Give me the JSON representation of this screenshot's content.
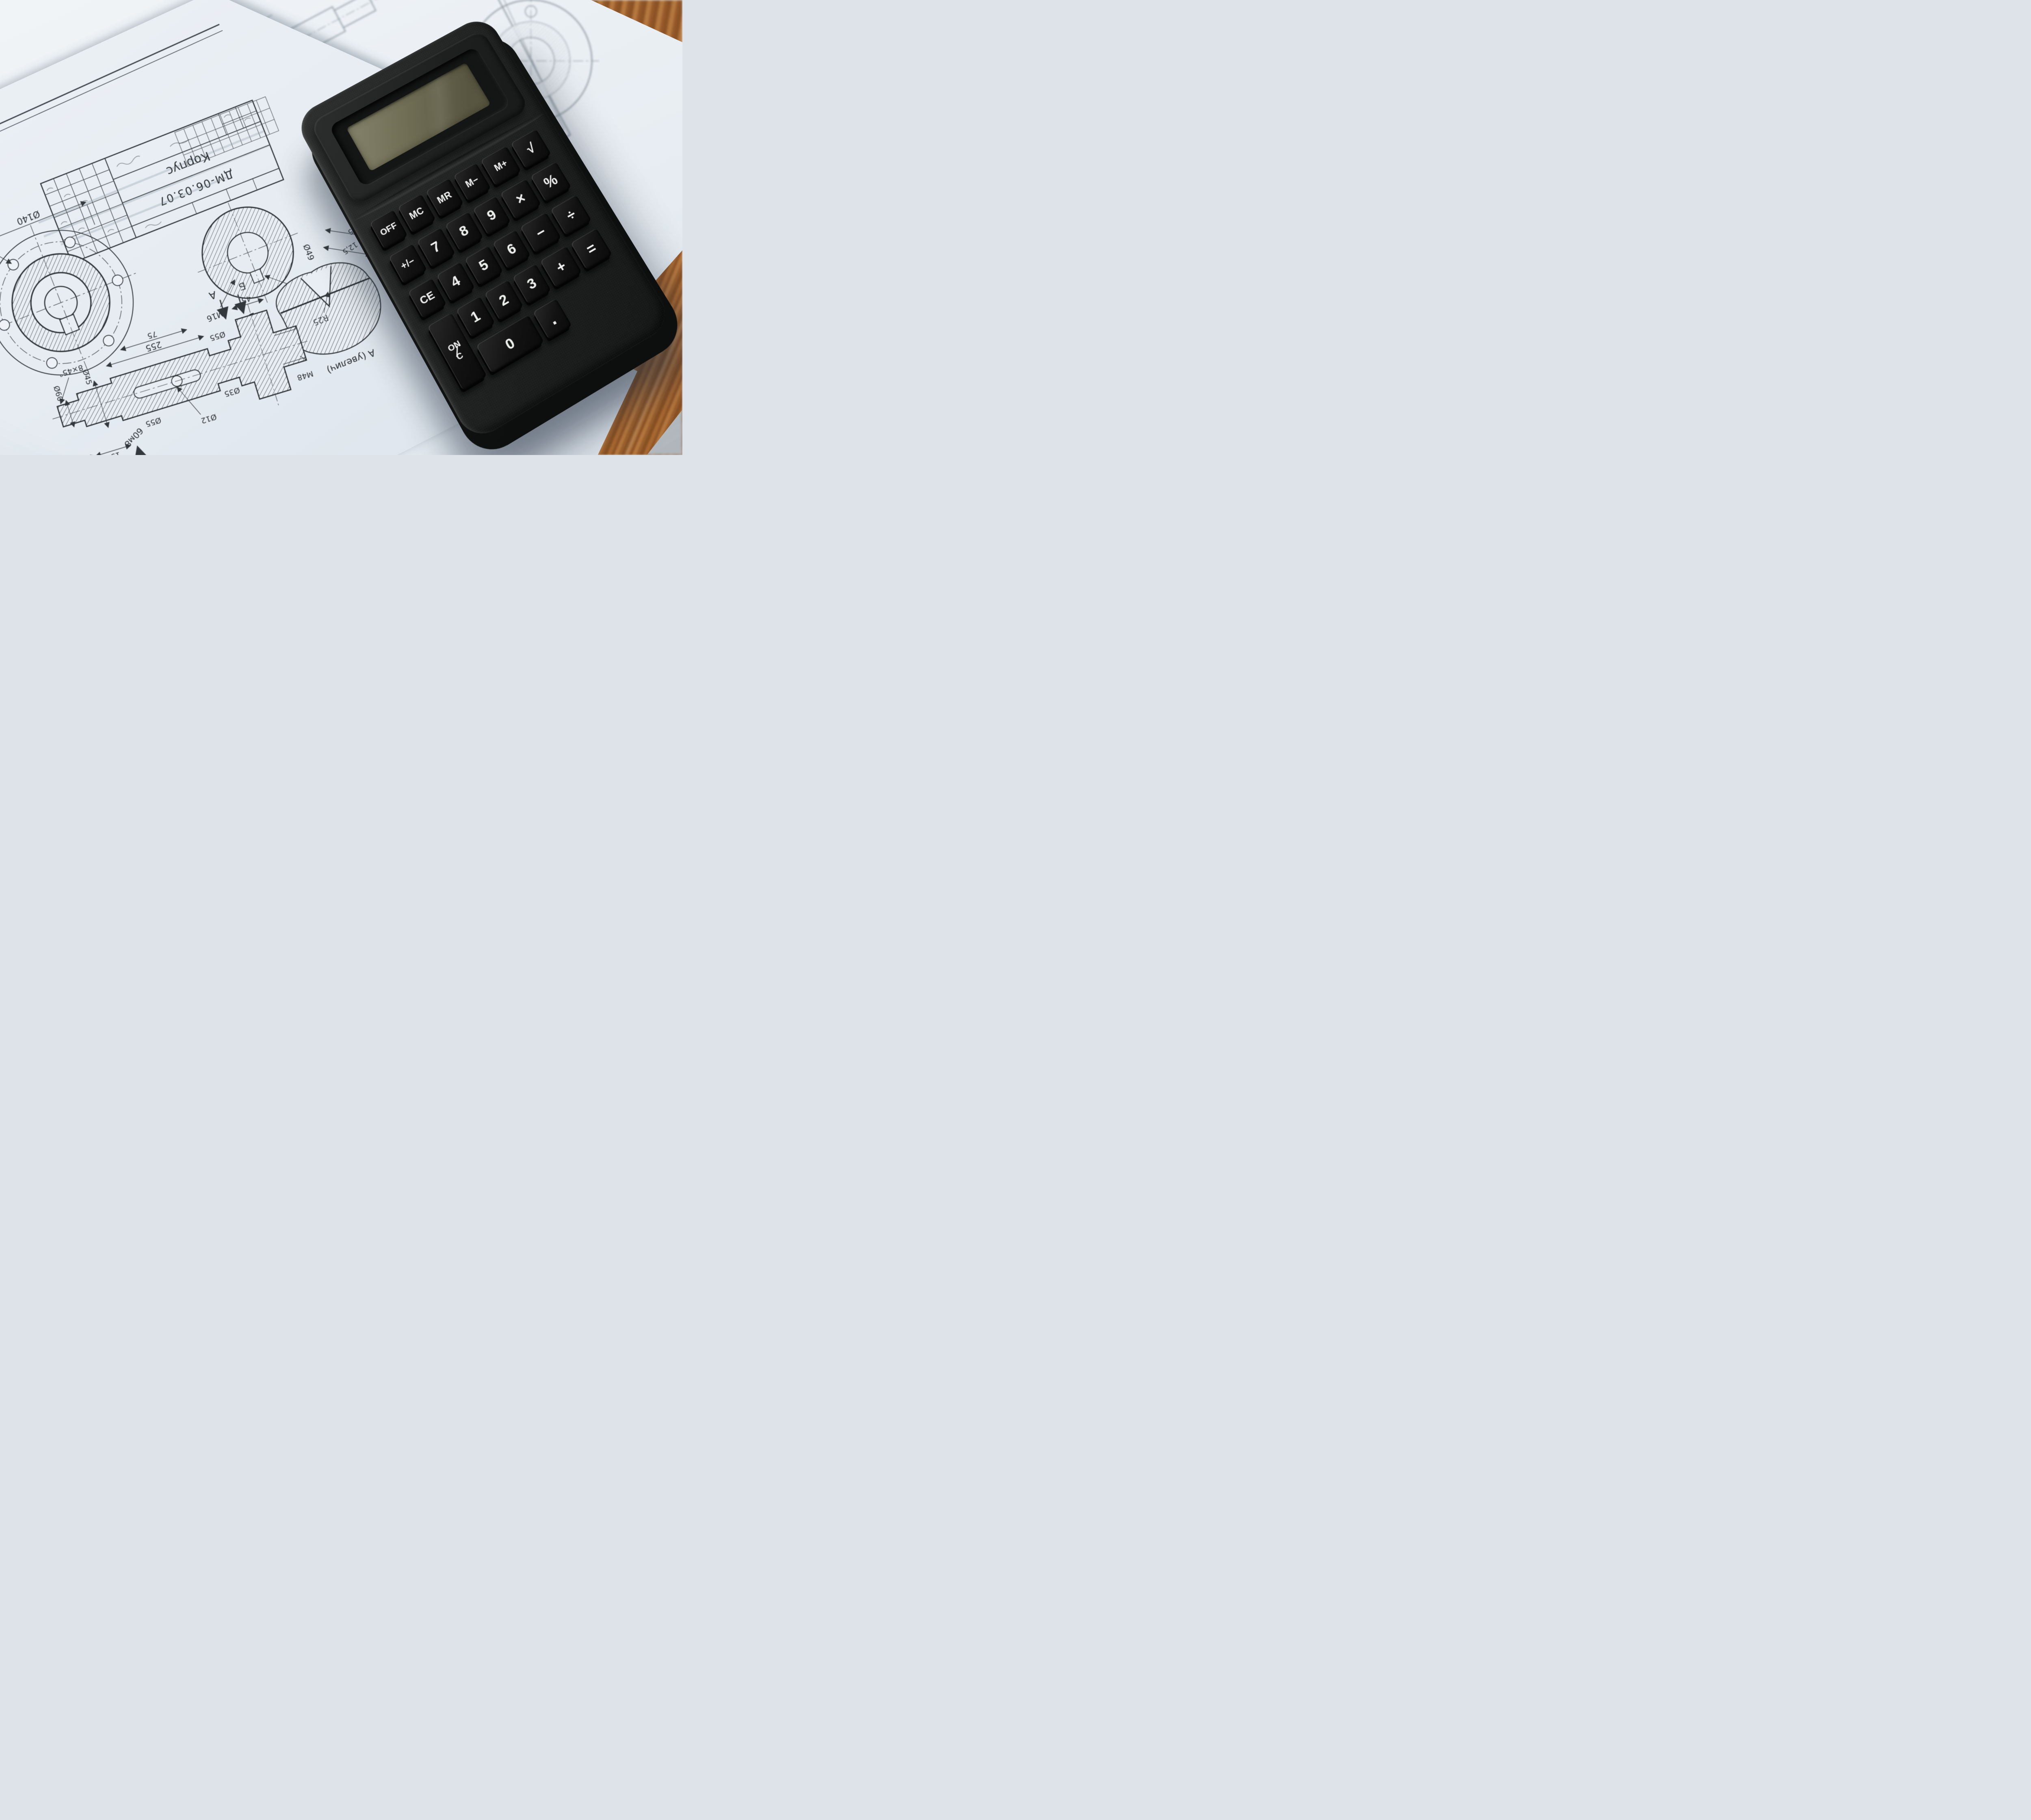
{
  "scene_colors": {
    "paper": "#e8eef3",
    "paper_shadowed": "#dfe7ee",
    "ink": "#2f3437",
    "wood": "#a96a33",
    "floor": "#b7bdc1",
    "calculator_body": "#222423",
    "key_face": "#121212",
    "key_legend": "#eef0ee",
    "lcd": "#6e6c53"
  },
  "calculator": {
    "display_value": "",
    "keys": {
      "off": {
        "label": "OFF"
      },
      "mc": {
        "label": "MC"
      },
      "mr": {
        "label": "MR"
      },
      "mminus": {
        "label": "M−"
      },
      "mplus": {
        "label": "M+"
      },
      "sqrt": {
        "label": "√"
      },
      "plusminus": {
        "label": "+/−"
      },
      "k7": {
        "label": "7"
      },
      "k8": {
        "label": "8"
      },
      "k9": {
        "label": "9"
      },
      "mul": {
        "label": "×"
      },
      "pct": {
        "label": "%"
      },
      "ce": {
        "label": "CE"
      },
      "k4": {
        "label": "4"
      },
      "k5": {
        "label": "5"
      },
      "k6": {
        "label": "6"
      },
      "minus": {
        "label": "−"
      },
      "div": {
        "label": "÷"
      },
      "onc": {
        "top": "ON",
        "bottom": "C"
      },
      "k1": {
        "label": "1"
      },
      "k2": {
        "label": "2"
      },
      "k3": {
        "label": "3"
      },
      "plus": {
        "label": "+"
      },
      "eq": {
        "label": "="
      },
      "k0": {
        "label": "0"
      },
      "dot": {
        "label": "."
      }
    }
  },
  "blueprint": {
    "title_block": {
      "part_name": "Корпус",
      "drawing_code": "ДМ-06.03.07"
    },
    "labels": {
      "d140": "Ø140",
      "m20": "М20",
      "bb": "Б-Б",
      "m16": "М16",
      "faski": "2 фаски",
      "ch16": "1,6×45°",
      "len255": "255",
      "d49": "Ø49",
      "r25": "R25",
      "detail_a": "А (увелич)",
      "d185": "18,5",
      "d125": "12,5",
      "ch8": "8×45°",
      "d60": "Ø60",
      "d45": "Ø45",
      "d12": "Ø12",
      "d55": "Ø55",
      "d35": "Ø35",
      "m48": "М48",
      "n20": "20",
      "n15": "15",
      "n60": "60",
      "n75": "75",
      "n45": "45",
      "d60m8": "60м8",
      "sec_a": "А",
      "sec_b": "Б"
    }
  }
}
